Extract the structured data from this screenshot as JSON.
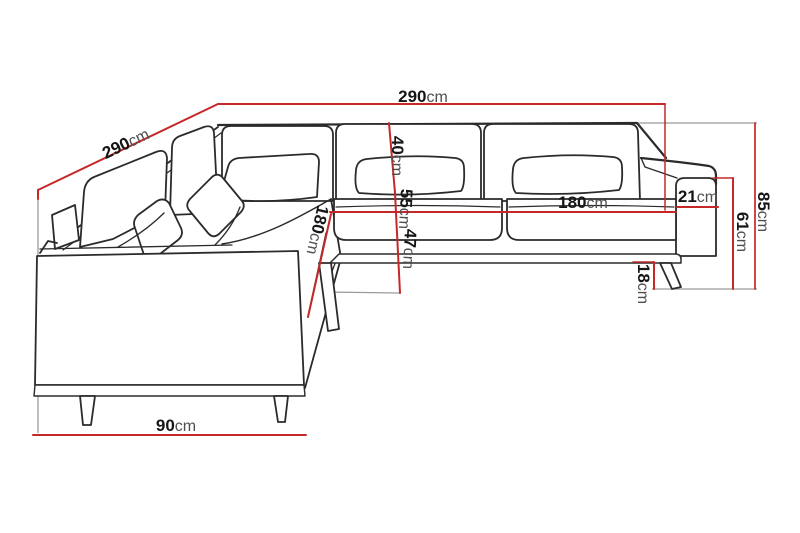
{
  "title": "Corner sofa dimension diagram",
  "unit_default": "cm",
  "colors": {
    "dimension_line": "#c52828",
    "sofa_outline": "#2b2b2b",
    "extension_line": "#9b9b9b",
    "background": "#ffffff",
    "label_number": "#161616",
    "label_unit": "#4f4f4f"
  },
  "dimensions": {
    "top_width": {
      "value": "290",
      "unit": "cm"
    },
    "left_depth": {
      "value": "290",
      "unit": "cm"
    },
    "back_height_40": {
      "value": "40",
      "unit": "cm"
    },
    "mid_height_55": {
      "value": "55",
      "unit": "cm"
    },
    "seat_height_47": {
      "value": "47",
      "unit": "cm"
    },
    "seat_width_180": {
      "value": "180",
      "unit": "cm"
    },
    "armrest_width": {
      "value": "21",
      "unit": "cm"
    },
    "left_length_180": {
      "value": "180",
      "unit": "cm"
    },
    "total_height": {
      "value": "85",
      "unit": "cm"
    },
    "arm_height": {
      "value": "61",
      "unit": "cm"
    },
    "leg_height": {
      "value": "18",
      "unit": "cm"
    },
    "end_width": {
      "value": "90",
      "unit": "cm"
    }
  }
}
